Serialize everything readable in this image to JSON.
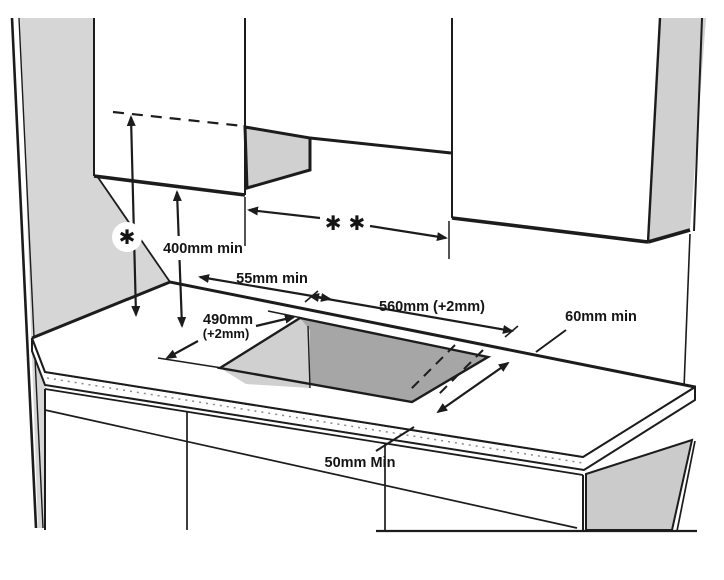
{
  "diagram": {
    "type": "built-in hob installation clearance diagram",
    "labels": {
      "hood_clearance_symbol": "✱",
      "hood_width_symbol": "✱ ✱",
      "cabinet_clearance": "400mm min",
      "rear_clearance": "55mm min",
      "cutout_width": "560mm (+2mm)",
      "cutout_depth": "490mm",
      "cutout_depth_tolerance": "(+2mm)",
      "side_clearance": "60mm min",
      "front_clearance": "50mm Min"
    },
    "colors": {
      "line": "#1c1c1c",
      "wall_shade": "#d6d6d6",
      "cabinet_side_shade": "#d0d0d0",
      "panel_shade": "#cbcbcb",
      "cutout_floor": "#a6a6a6",
      "cutout_wall": "#d0d0d0"
    }
  }
}
